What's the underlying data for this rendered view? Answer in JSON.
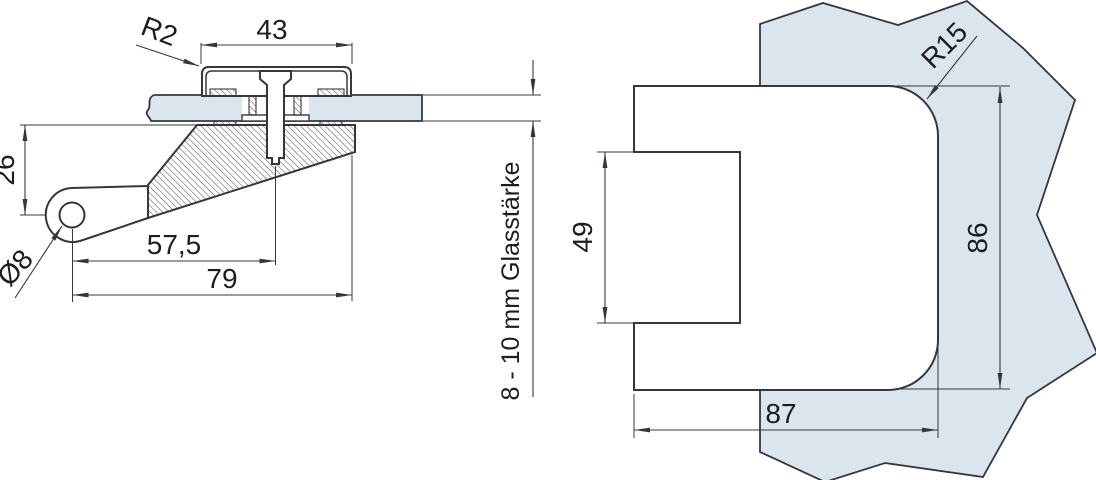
{
  "colors": {
    "background": "#ffffff",
    "line": "#34383d",
    "glass": "#dbe5ee",
    "text": "#1b1d1f"
  },
  "left_view": {
    "labels": {
      "corner_radius": "R2",
      "cover_width": "43",
      "pivot_height": "26",
      "hole_diameter": "Ø8",
      "pivot_to_screw": "57,5",
      "pivot_to_edge": "79",
      "glass_thickness": "8 - 10 mm Glasstärke"
    }
  },
  "right_view": {
    "labels": {
      "corner_radius": "R15",
      "slot_height": "49",
      "body_height": "86",
      "body_width": "87"
    }
  }
}
